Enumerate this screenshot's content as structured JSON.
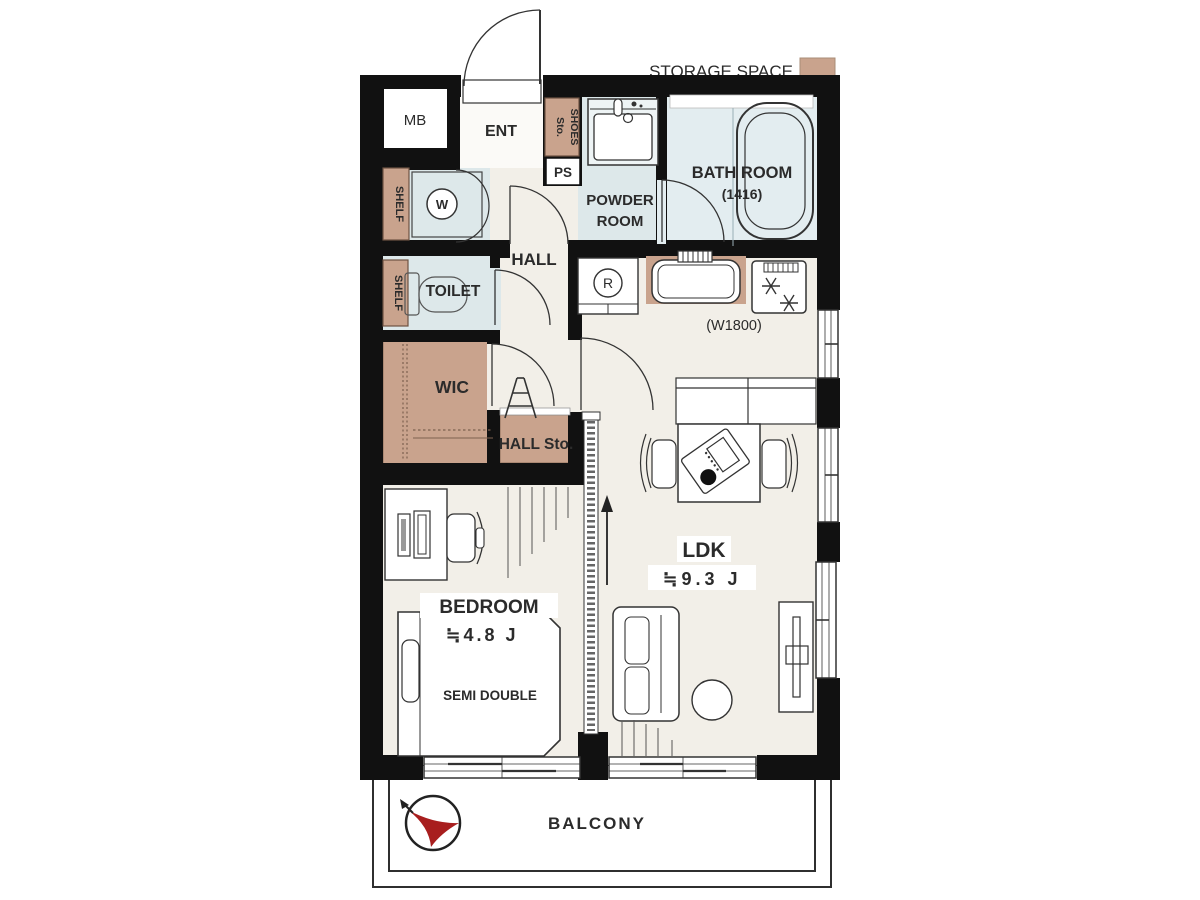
{
  "legend": {
    "label": "STORAGE SPACE"
  },
  "colors": {
    "storage": "#c9a38d",
    "wet": "#dde8ea",
    "bath": "#e3edf0",
    "floor": "#f2efe8",
    "wall": "#111111",
    "compass_red": "#a81e1e"
  },
  "plan": {
    "mb": "MB",
    "ent": "ENT",
    "shoes_line1": "SHOES",
    "shoes_line2": "Sto.",
    "pipe_space": "PS",
    "powder_line1": "POWDER",
    "powder_line2": "ROOM",
    "bath_room": "BATH ROOM",
    "bath_size": "(1416)",
    "shelf_washer": "SHELF",
    "washer": "W",
    "toilet": "TOILET",
    "shelf_toilet": "SHELF",
    "wic": "WIC",
    "hall": "HALL",
    "hall_storage": "HALL Sto.",
    "refrigerator": "R",
    "kitchen_width": "(W1800)",
    "ldk": "LDK",
    "ldk_size": "≒9.3 J",
    "bedroom": "BEDROOM",
    "bedroom_size": "≒4.8 J",
    "bed_type": "SEMI DOUBLE",
    "balcony": "BALCONY"
  }
}
